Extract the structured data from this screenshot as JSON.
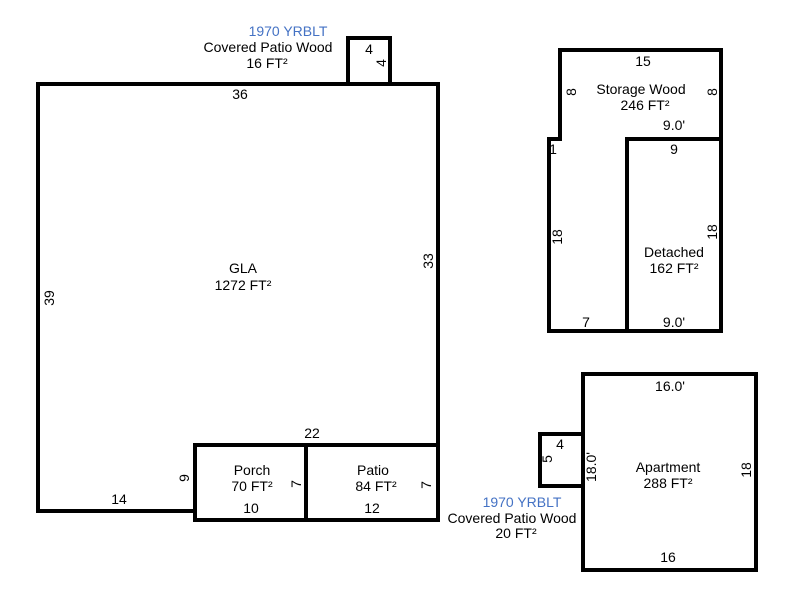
{
  "colors": {
    "wall": "#000000",
    "text": "#000000",
    "year_blue": "#4472C4"
  },
  "sketch": {
    "gla": {
      "name": "GLA",
      "area": "1272 FT²",
      "dim_top": "36",
      "dim_left": "39",
      "dim_right": "33",
      "dim_bottom_left": "14",
      "dim_notch_horizontal": "22",
      "dim_notch_vertical": "9"
    },
    "covered_patio_top": {
      "yrblt": "1970 YRBLT",
      "name": "Covered Patio Wood",
      "area": "16 FT²",
      "dim_top": "4",
      "dim_right": "4"
    },
    "porch": {
      "name": "Porch",
      "area": "70 FT²",
      "dim_right": "7",
      "dim_bottom": "10"
    },
    "patio": {
      "name": "Patio",
      "area": "84 FT²",
      "dim_right": "7",
      "dim_bottom": "12"
    },
    "storage": {
      "name": "Storage Wood",
      "area": "246 FT²",
      "dim_top": "15",
      "dim_left_upper": "8",
      "dim_right_upper": "8",
      "dim_jog": "1",
      "dim_left_lower": "18",
      "dim_bottom": "7",
      "dim_inner_top": "9.0'"
    },
    "detached": {
      "name": "Detached",
      "area": "162 FT²",
      "dim_top": "9",
      "dim_right": "18",
      "dim_bottom": "9.0'"
    },
    "apartment": {
      "name": "Apartment",
      "area": "288 FT²",
      "dim_top": "16.0'",
      "dim_right": "18",
      "dim_left": "18.0'",
      "dim_bottom": "16"
    },
    "covered_patio_bottom": {
      "yrblt": "1970 YRBLT",
      "name": "Covered Patio Wood",
      "area": "20 FT²",
      "dim_top": "4",
      "dim_left": "5"
    }
  }
}
